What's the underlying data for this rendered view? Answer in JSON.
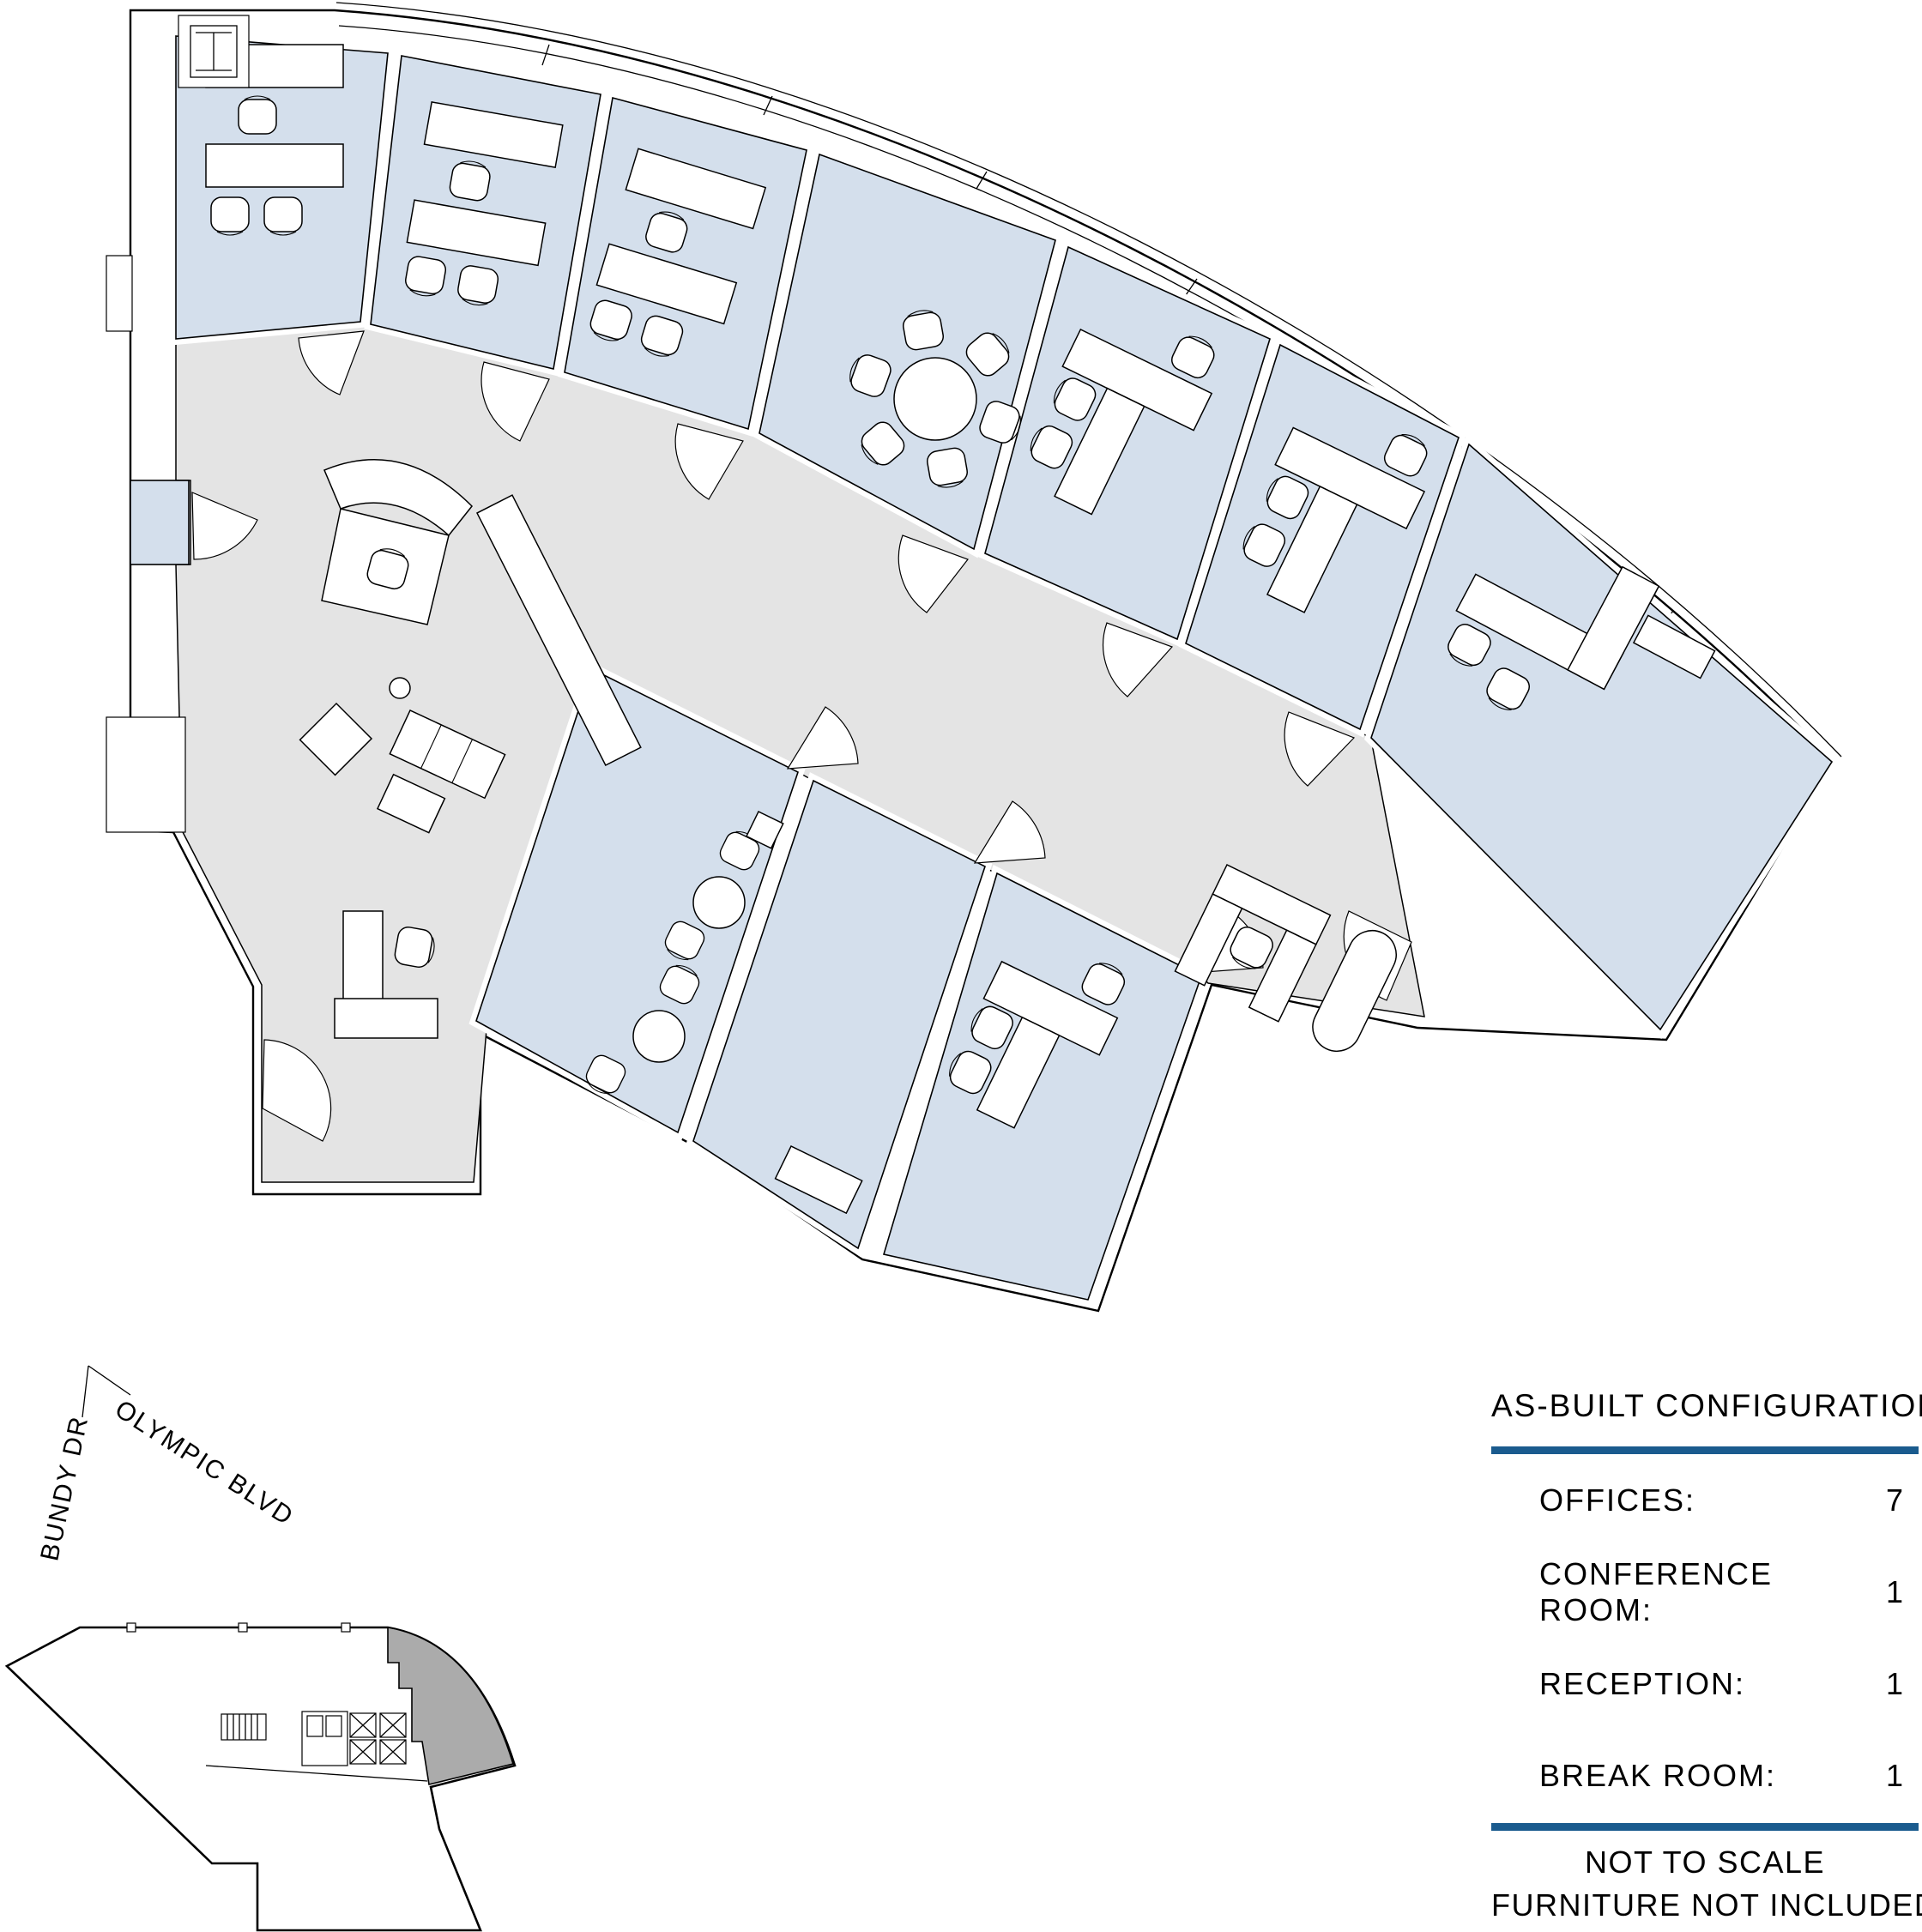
{
  "document": {
    "type": "architectural floor plan",
    "sheet_background": "#ffffff"
  },
  "legend": {
    "title": "AS-BUILT CONFIGURATION",
    "rows": [
      {
        "label": "OFFICES:",
        "value": "7"
      },
      {
        "label": "CONFERENCE ROOM:",
        "value": "1"
      },
      {
        "label": "RECEPTION:",
        "value": "1"
      },
      {
        "label": "BREAK ROOM:",
        "value": "1"
      }
    ],
    "notes": [
      "NOT TO SCALE",
      "FURNITURE NOT INCLUDED"
    ]
  },
  "streets": {
    "street_1": "BUNDY DR",
    "street_2": "OLYMPIC BLVD"
  },
  "colors": {
    "accent_rule": "#1a5b8e",
    "office_fill": "#d4dfec",
    "open_area_fill": "#e4e4e4",
    "keyplan_suite_fill": "#ababab",
    "wall_line": "#000000"
  },
  "plan": {
    "rooms": [
      {
        "name": "office-1",
        "type": "office"
      },
      {
        "name": "office-2",
        "type": "office"
      },
      {
        "name": "office-3",
        "type": "office"
      },
      {
        "name": "conference-room",
        "type": "conference"
      },
      {
        "name": "office-4",
        "type": "office"
      },
      {
        "name": "office-5",
        "type": "office"
      },
      {
        "name": "office-6",
        "type": "office"
      },
      {
        "name": "break-room",
        "type": "break room"
      },
      {
        "name": "office-7",
        "type": "office"
      },
      {
        "name": "reception",
        "type": "reception / open area"
      },
      {
        "name": "entry-vestibule",
        "type": "vestibule"
      }
    ]
  }
}
